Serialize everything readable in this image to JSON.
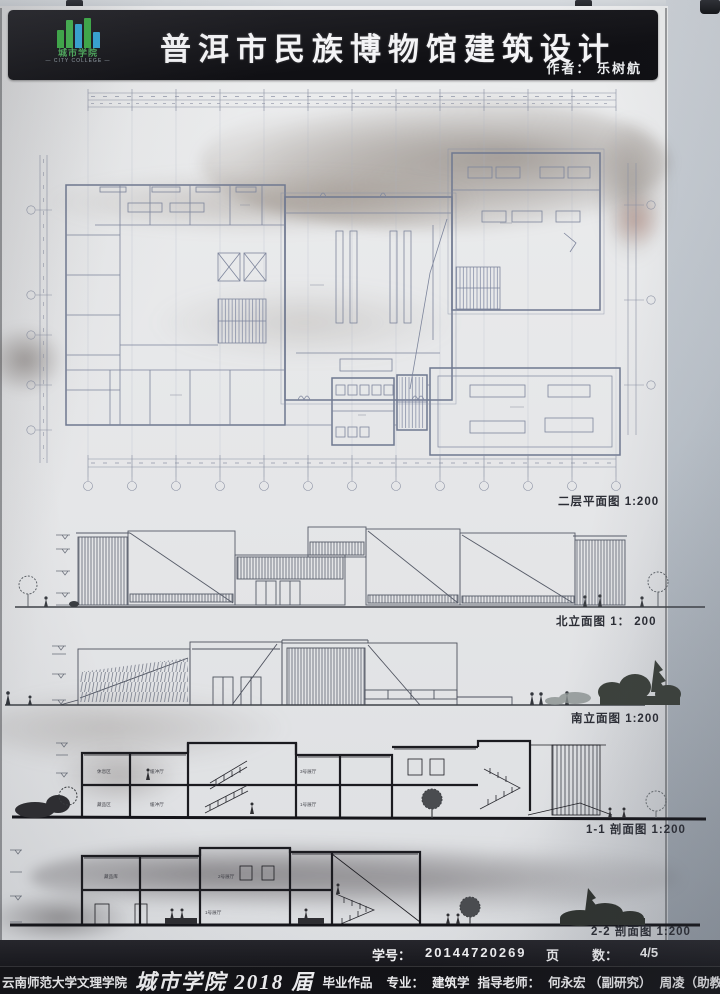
{
  "header": {
    "title": "普洱市民族博物馆建筑设计",
    "author": "作者：  乐树航",
    "logo_text": "城市学院",
    "logo_subtext": "— CITY COLLEGE —"
  },
  "drawings": {
    "plan": {
      "caption": "二层平面图 1:200"
    },
    "north_elevation": {
      "caption": "北立面图 1： 200"
    },
    "south_elevation": {
      "caption": "南立面图 1:200"
    },
    "section_1_1": {
      "caption": "1-1 剖面图 1:200",
      "room_labels": [
        "休息区",
        "缓冲厅",
        "3号展厅",
        "藏品区",
        "缓冲厅",
        "1号展厅"
      ]
    },
    "section_2_2": {
      "caption": "2-2 剖面图 1:200",
      "room_labels": [
        "藏品库",
        "2号展厅",
        "1号展厅"
      ]
    }
  },
  "footer": {
    "student_id_label": "学号：",
    "student_id": "20144720269",
    "pages_label": "页",
    "count_label": "数：",
    "pages_value": "4/5",
    "university": "云南师范大学文理学院",
    "school": "城市学院 2018 届",
    "work_type": "毕业作品",
    "major_label": "专业：",
    "major": "建筑学",
    "advisor_label": "指导老师：",
    "advisor_1": "何永宏 （副研究）",
    "advisor_2": "周凌（助教"
  },
  "colors": {
    "logo_green": "#3fae49",
    "logo_blue": "#37a8d8",
    "plan_line": "#6f7890",
    "section_line": "#1b1b20"
  }
}
